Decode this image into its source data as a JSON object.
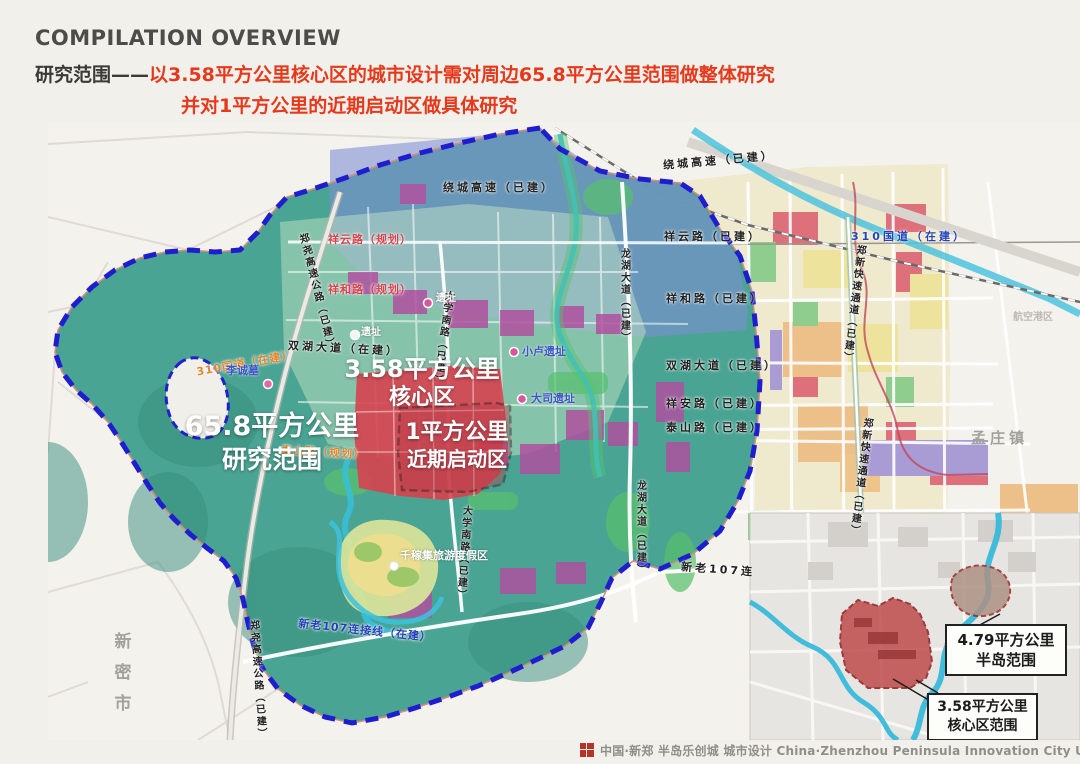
{
  "page": {
    "title": "COMPILATION OVERVIEW",
    "range_prefix": "研究范围——",
    "range_red1": "以3.58平方公里核心区的城市设计需对周边65.8平方公里范围做整体研究",
    "range_red2": "并对1平方公里的近期启动区做具体研究"
  },
  "map": {
    "area": {
      "study1": "65.8平方公里",
      "study2": "研究范围",
      "core1": "3.58平方公里",
      "core2": "核心区",
      "start1": "1平方公里",
      "start2": "近期启动区"
    },
    "roads": {
      "raocheng": "绕城高速（已建）",
      "xiangyun_plan": "祥云路（规划）",
      "xianghe_plan": "祥和路（规划）",
      "xiangyun_built": "祥云路（已建）",
      "xianghe_built": "祥和路（已建）",
      "shuanghu_built": "双湖大道（已建）",
      "shuanghu_constr": "双湖大道（在建）",
      "xiangan_built": "祥安路（已建）",
      "taishan_built": "泰山路（已建）",
      "taishan_plan": "泰山路（规划）",
      "g310": "310国道（在建）",
      "daxue": "大学南路（已建）",
      "longhu": "龙湖大道（已建）",
      "zhengxin": "郑新快速通道（已建）",
      "zhengyao": "郑尧高速公路（已建）",
      "xinlao107": "新老107连接线（在建）",
      "xinlao107_short": "新老107连"
    },
    "places": {
      "xinmi": "新密市",
      "mengzhuang": "孟庄镇",
      "konggang": "航空港区",
      "licheng": "李诚墓",
      "xiaolu": "小卢遗址",
      "dasi": "大司遗址",
      "ruins": "遗址",
      "qianjiaji": "千稼集旅游度假区"
    }
  },
  "inset": {
    "p1a": "4.79平方公里",
    "p1b": "半岛范围",
    "p2a": "3.58平方公里",
    "p2b": "核心区范围"
  },
  "footer": {
    "caption": "中国·新郑 半岛乐创城 城市设计 China·Zhenzhou Peninsula Innovation City Urban Design"
  },
  "colors": {
    "accent_red": "#e6391c",
    "boundary_blue": "#1e1ecf",
    "study_teal": "#43a08f",
    "core_red": "#d7434f"
  }
}
